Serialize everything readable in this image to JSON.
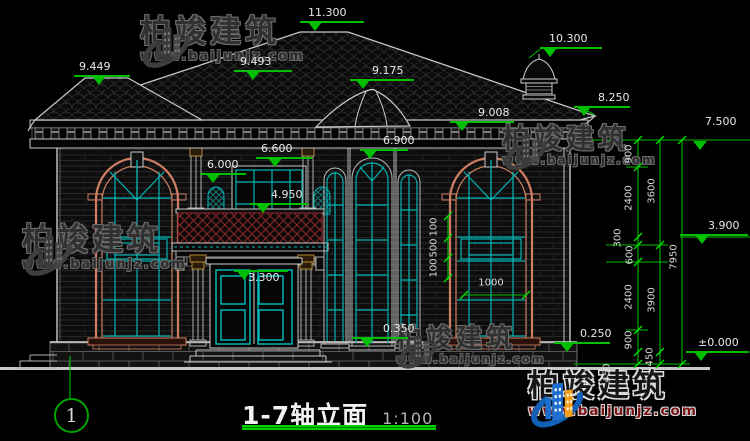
{
  "drawing_title": {
    "name": "1-7轴立面",
    "scale": "1:100"
  },
  "axis_marker": {
    "label": "1"
  },
  "brand": {
    "name": "柏竣建筑",
    "url": "www.baijunjz.com"
  },
  "colors": {
    "dim_green": "#00bf00",
    "tick_green": "#00e000",
    "dim_text": "#e8e8e8",
    "line_white": "#c8c8c8",
    "teal": "#00b4b4",
    "salmon": "#cf7e62",
    "lattice_red": "#8b2424",
    "capital_gold": "#b5862b",
    "logo_blue": "#1e6fd0",
    "logo_orange": "#f5a01a",
    "url_red": "#7a1516",
    "title_green": "#00c800"
  },
  "level_markers": [
    {
      "v": "11.300",
      "tx": 308,
      "ty": 7,
      "lx": 300,
      "ly": 21,
      "lw": 64,
      "ax": 308
    },
    {
      "v": "9.449",
      "tx": 79,
      "ty": 61,
      "lx": 74,
      "ly": 75,
      "lw": 56,
      "ax": 92
    },
    {
      "v": "9.493",
      "tx": 240,
      "ty": 56,
      "lx": 234,
      "ly": 70,
      "lw": 58,
      "ax": 246
    },
    {
      "v": "9.175",
      "tx": 372,
      "ty": 65,
      "lx": 350,
      "ly": 79,
      "lw": 64,
      "ax": 356
    },
    {
      "v": "10.300",
      "tx": 549,
      "ty": 33,
      "lx": 540,
      "ly": 47,
      "lw": 62,
      "ax": 543
    },
    {
      "v": "9.008",
      "tx": 478,
      "ty": 107,
      "lx": 450,
      "ly": 121,
      "lw": 64,
      "ax": 455
    },
    {
      "v": "8.250",
      "tx": 598,
      "ty": 92,
      "lx": 574,
      "ly": 106,
      "lw": 56,
      "ax": 577
    },
    {
      "v": "7.500",
      "tx": 705,
      "ty": 116,
      "lx": 660,
      "ly": 140,
      "lw": 0,
      "ax": 693
    },
    {
      "v": "6.900",
      "tx": 383,
      "ty": 135,
      "lx": 360,
      "ly": 149,
      "lw": 48,
      "ax": 363
    },
    {
      "v": "6.600",
      "tx": 261,
      "ty": 143,
      "lx": 256,
      "ly": 157,
      "lw": 56,
      "ax": 268
    },
    {
      "v": "6.000",
      "tx": 207,
      "ty": 159,
      "lx": 200,
      "ly": 173,
      "lw": 46,
      "ax": 206
    },
    {
      "v": "4.950",
      "tx": 271,
      "ty": 189,
      "lx": 250,
      "ly": 203,
      "lw": 58,
      "ax": 256
    },
    {
      "v": "3.300",
      "tx": 248,
      "ty": 272,
      "lx": 234,
      "ly": 270,
      "lw": 54,
      "ax": 237
    },
    {
      "v": "0.350",
      "tx": 383,
      "ty": 323,
      "lx": 352,
      "ly": 337,
      "lw": 56,
      "ax": 360
    },
    {
      "v": "0.250",
      "tx": 580,
      "ty": 328,
      "lx": 554,
      "ly": 342,
      "lw": 56,
      "ax": 560
    },
    {
      "v": "3.900",
      "tx": 708,
      "ty": 220,
      "lx": 680,
      "ly": 234,
      "lw": 68,
      "ax": 695
    },
    {
      "v": "±0.000",
      "tx": 698,
      "ty": 337,
      "lx": 686,
      "ly": 351,
      "lw": 62,
      "ax": 694
    }
  ],
  "linear_dims": [
    {
      "v": "900",
      "x": 629,
      "y": 154,
      "rot": 1
    },
    {
      "v": "2400",
      "x": 629,
      "y": 198,
      "rot": 1
    },
    {
      "v": "300",
      "x": 618,
      "y": 238,
      "rot": 1
    },
    {
      "v": "600",
      "x": 630,
      "y": 255,
      "rot": 1
    },
    {
      "v": "2400",
      "x": 629,
      "y": 297,
      "rot": 1
    },
    {
      "v": "900",
      "x": 629,
      "y": 340,
      "rot": 1
    },
    {
      "v": "450",
      "x": 650,
      "y": 357,
      "rot": 1
    },
    {
      "v": "450",
      "x": 607,
      "y": 373,
      "rot": 1
    },
    {
      "v": "3600",
      "x": 652,
      "y": 191,
      "rot": 1
    },
    {
      "v": "3900",
      "x": 652,
      "y": 300,
      "rot": 1
    },
    {
      "v": "7950",
      "x": 674,
      "y": 257,
      "rot": 1
    },
    {
      "v": "100",
      "x": 434,
      "y": 227,
      "rot": 1
    },
    {
      "v": "500",
      "x": 434,
      "y": 248,
      "rot": 1
    },
    {
      "v": "100",
      "x": 434,
      "y": 268,
      "rot": 1
    },
    {
      "v": "1000",
      "x": 491,
      "y": 283,
      "rot": 0
    }
  ],
  "watermarks": [
    {
      "variant": "gray",
      "x": 140,
      "y": 16,
      "h": 56,
      "f": 31,
      "uf": 13
    },
    {
      "variant": "gray",
      "x": 502,
      "y": 124,
      "h": 50,
      "f": 28,
      "uf": 12
    },
    {
      "variant": "gray",
      "x": 22,
      "y": 224,
      "h": 56,
      "f": 31,
      "uf": 13
    },
    {
      "variant": "gray",
      "x": 396,
      "y": 326,
      "h": 46,
      "f": 26,
      "uf": 11.5
    },
    {
      "variant": "color",
      "x": 528,
      "y": 370,
      "h": 62,
      "f": 31,
      "uf": 13.5
    }
  ]
}
